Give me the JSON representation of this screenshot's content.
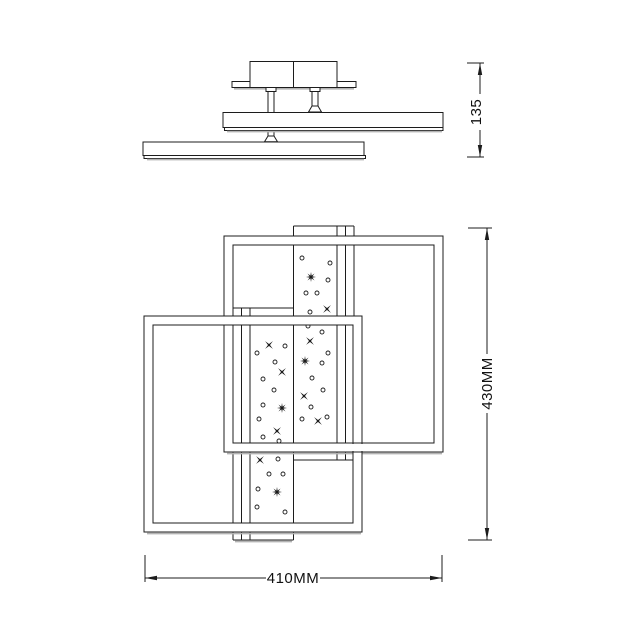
{
  "dimensions": {
    "canopy_height": {
      "label": "135"
    },
    "fixture_height": {
      "label": "430MM"
    },
    "fixture_width": {
      "label": "410MM"
    }
  },
  "colors": {
    "line": "#1c1c1c",
    "background": "#ffffff",
    "shadow": "#b3b3b3"
  }
}
